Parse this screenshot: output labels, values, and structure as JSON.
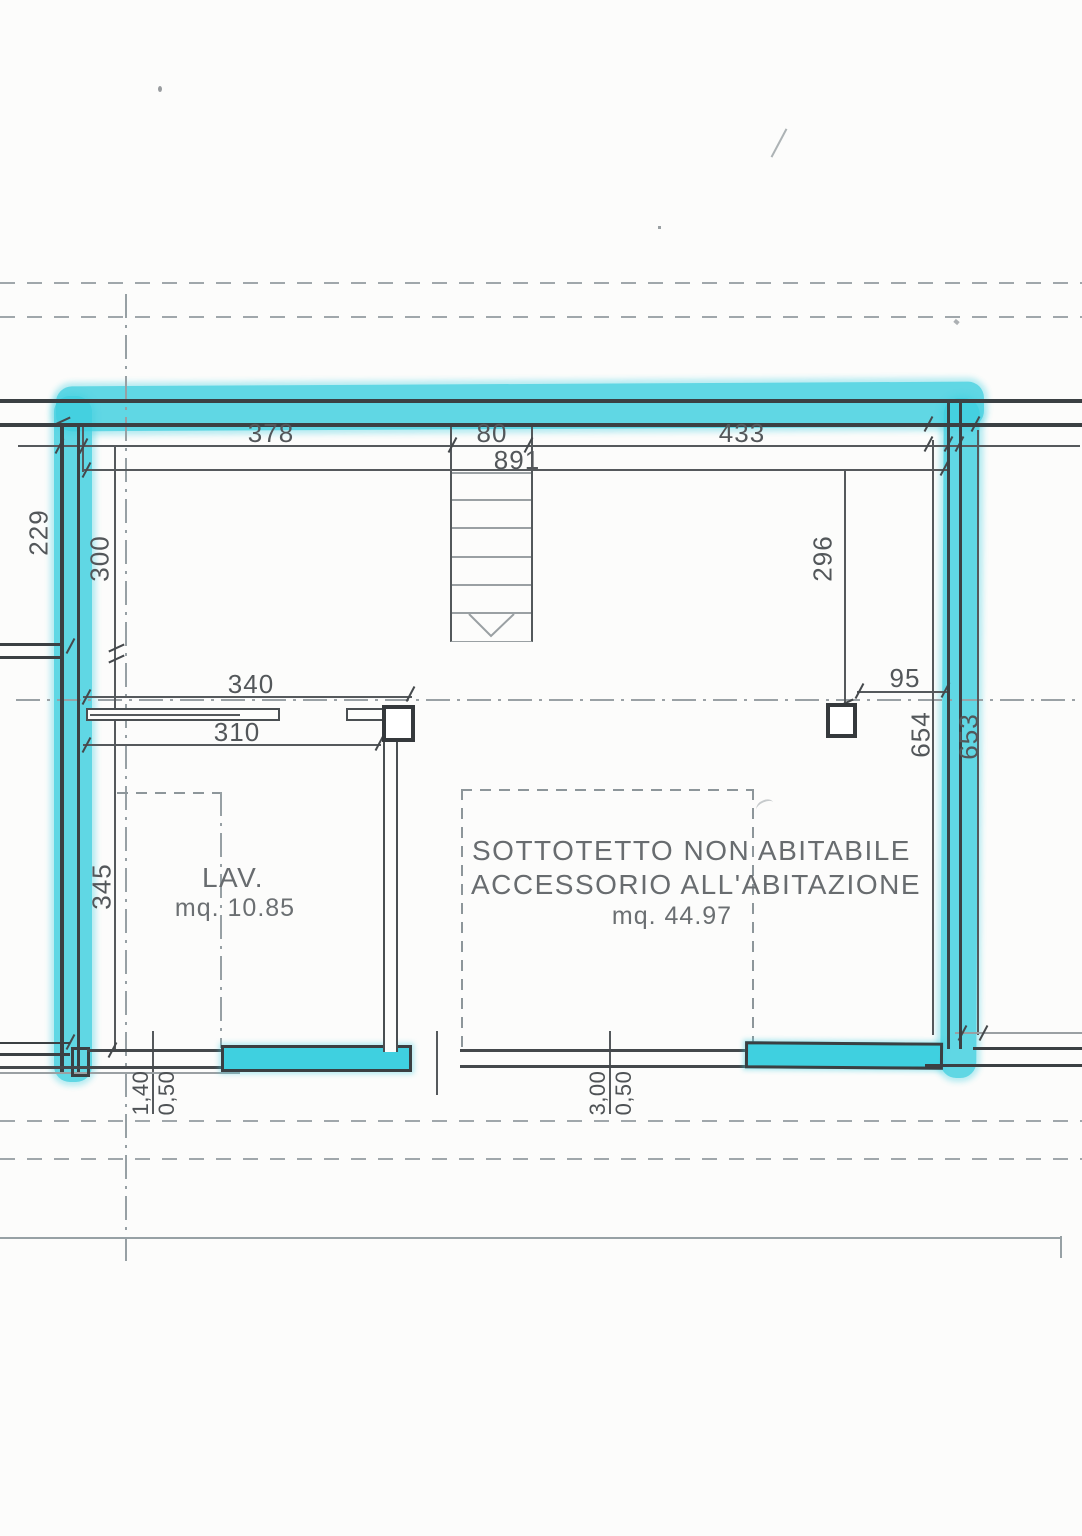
{
  "plan": {
    "kind": "attic floor plan (scanned, walls highlighted with cyan marker)",
    "rooms": {
      "lav": {
        "name": "LAV.",
        "area": "mq. 10.85"
      },
      "sottotetto": {
        "line1": "SOTTOTETTO NON ABITABILE",
        "line2": "ACCESSORIO ALL'ABITAZIONE",
        "area": "mq. 44.97"
      }
    },
    "dimensions": {
      "top_segment_left": "378",
      "top_segment_middle": "80",
      "top_segment_right": "433",
      "top_overall": "891",
      "left_upper_outer": "229",
      "left_upper_inner": "300",
      "right_upper": "296",
      "pillar_to_wall": "95",
      "right_run_inner": "654",
      "right_run_outer": "653",
      "partition_upper": "340",
      "partition_lower": "310",
      "lav_room_depth": "345",
      "window_left_height": "1,40",
      "window_left_sill": "0,50",
      "window_mid_height": "3,00",
      "window_mid_sill": "0,50",
      "edge_clipped_label": "0,50"
    },
    "colors": {
      "highlight": "#3ecfe0",
      "wall": "#3b4043",
      "line": "#55595c",
      "text": "#53575a"
    }
  }
}
